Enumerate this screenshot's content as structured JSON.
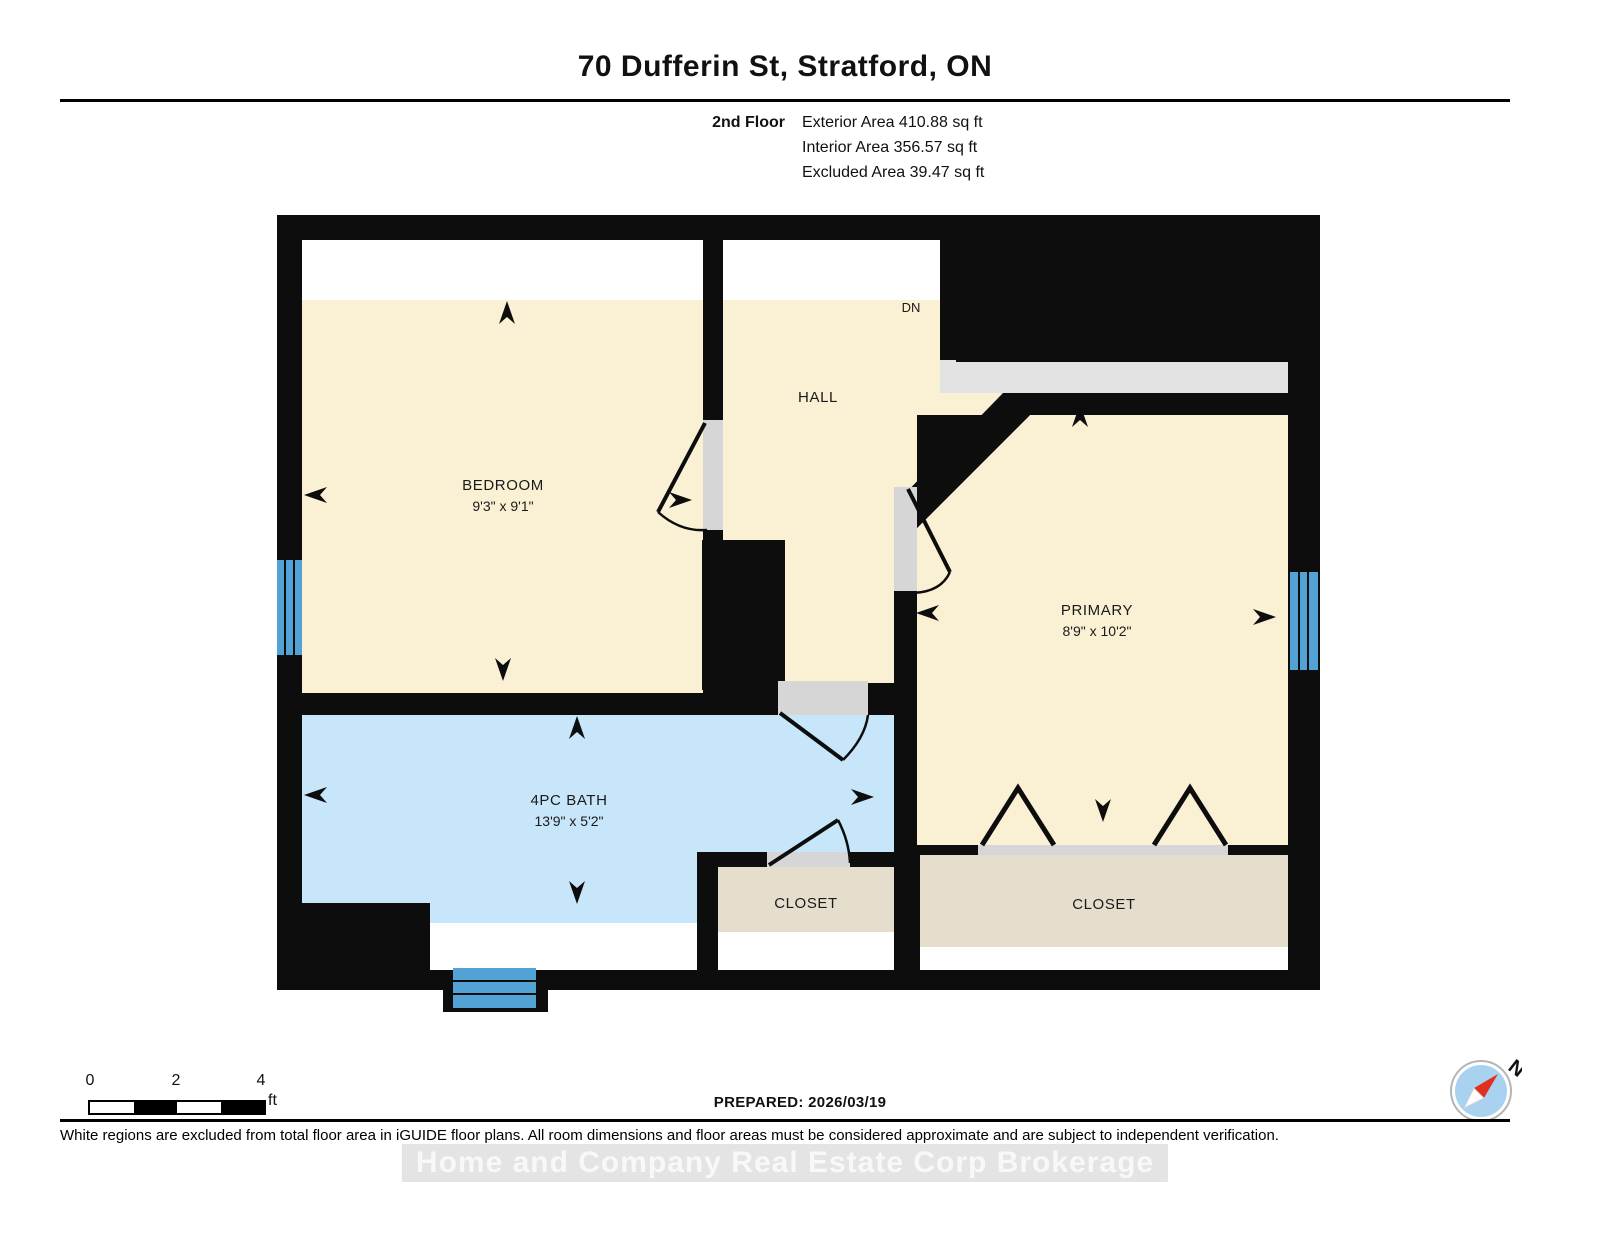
{
  "header": {
    "title": "70 Dufferin St, Stratford, ON",
    "floor_label": "2nd Floor",
    "exterior_area": "Exterior Area 410.88 sq ft",
    "interior_area": "Interior Area 356.57 sq ft",
    "excluded_area": "Excluded Area 39.47 sq ft"
  },
  "rooms": {
    "bedroom": {
      "label": "BEDROOM",
      "dims": "9'3\" x 9'1\""
    },
    "hall": {
      "label": "HALL"
    },
    "primary": {
      "label": "PRIMARY",
      "dims": "8'9\" x 10'2\""
    },
    "bath": {
      "label": "4PC BATH",
      "dims": "13'9\" x 5'2\""
    },
    "closet_center": {
      "label": "CLOSET"
    },
    "closet_right": {
      "label": "CLOSET"
    }
  },
  "stairs": {
    "down_label": "DN"
  },
  "scale_bar": {
    "tick_0": "0",
    "tick_2": "2",
    "tick_4": "4",
    "unit": "ft"
  },
  "compass": {
    "north_label": "N"
  },
  "footer": {
    "prepared_label": "PREPARED: 2026/03/19",
    "disclaimer": "White regions are excluded from total floor area in iGUIDE floor plans. All room dimensions and floor areas must be considered approximate and are subject to independent verification.",
    "watermark": "Home and Company Real Estate Corp Brokerage"
  },
  "colors": {
    "wall": "#0d0d0d",
    "room_beige": "#faf0d3",
    "bath_blue": "#c8e6fa",
    "closet_tan": "#e6decd",
    "stairs_gray": "#e3e3e3",
    "door_gray": "#d6d6d6",
    "window_blue": "#52a2d6",
    "excluded_white": "#ffffff",
    "compass_red": "#e03020",
    "compass_blue": "#a8d2ef"
  }
}
